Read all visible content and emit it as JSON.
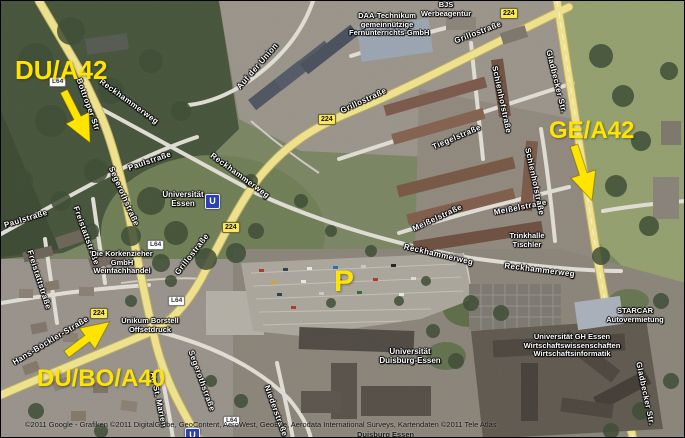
{
  "map": {
    "view": "satellite",
    "annotations": {
      "du_a42": "DU/A42",
      "ge_a42": "GE/A42",
      "du_bo_a40": "DU/BO/A40",
      "parking": "P",
      "color": "#ffe400"
    },
    "badges": {
      "b224": "224",
      "l64": "L64",
      "ubahn": "U"
    },
    "streets": {
      "bottroper": "Bottroper Str",
      "reckhammerweg": "Reckhammerweg",
      "grillo": "Grillostraße",
      "gladbecker": "Gladbecker Str.",
      "auf_der_union": "Auf der Union",
      "paul": "Paulstraße",
      "segeroth": "Segerothstraße",
      "tiegel": "Tiegelstraße",
      "meissel": "Meißelstraße",
      "schlenhof": "Schlenhofstraße",
      "hans_boeckler": "Hans-Böckler-Straße",
      "freistatt": "Freistattstraße",
      "nieder": "Niederstraße",
      "an_st_marien": "An St. Marien"
    },
    "pois": {
      "uni_essen": {
        "line1": "Universität",
        "line2": "Essen"
      },
      "uni_due": {
        "line1": "Universität",
        "line2": "Duisburg-Essen"
      },
      "uni_due_station": "Duisburg Essen",
      "daa": {
        "line1": "DAA-Technikum",
        "line2": "gemeinnützige",
        "line3": "Fernunterrichts-GmbH"
      },
      "bjs": {
        "line1": "BJS",
        "line2": "Werbeagentur"
      },
      "korkenzieher": {
        "line1": "Die Korkenzieher",
        "line2": "GmbH",
        "line3": "Weinfachhandel"
      },
      "unikum": {
        "line1": "Unikum Borstell",
        "line2": "Offsetdruck"
      },
      "starcar": {
        "line1": "STARCAR",
        "line2": "Autovermietung"
      },
      "uni_gh": {
        "line1": "Universität GH Essen",
        "line2": "Wirtschaftswissenschaften",
        "line3": "Wirtschaftsinformatik"
      },
      "trinkhalle": {
        "line1": "Trinkhalle",
        "line2": "Tischler"
      }
    },
    "attribution": "©2011 Google - Grafiken ©2011 DigitalGlobe, GeoContent, AeroWest, GeoEye, Aerodata International Surveys, Kartendaten ©2011 Tele Atlas"
  }
}
